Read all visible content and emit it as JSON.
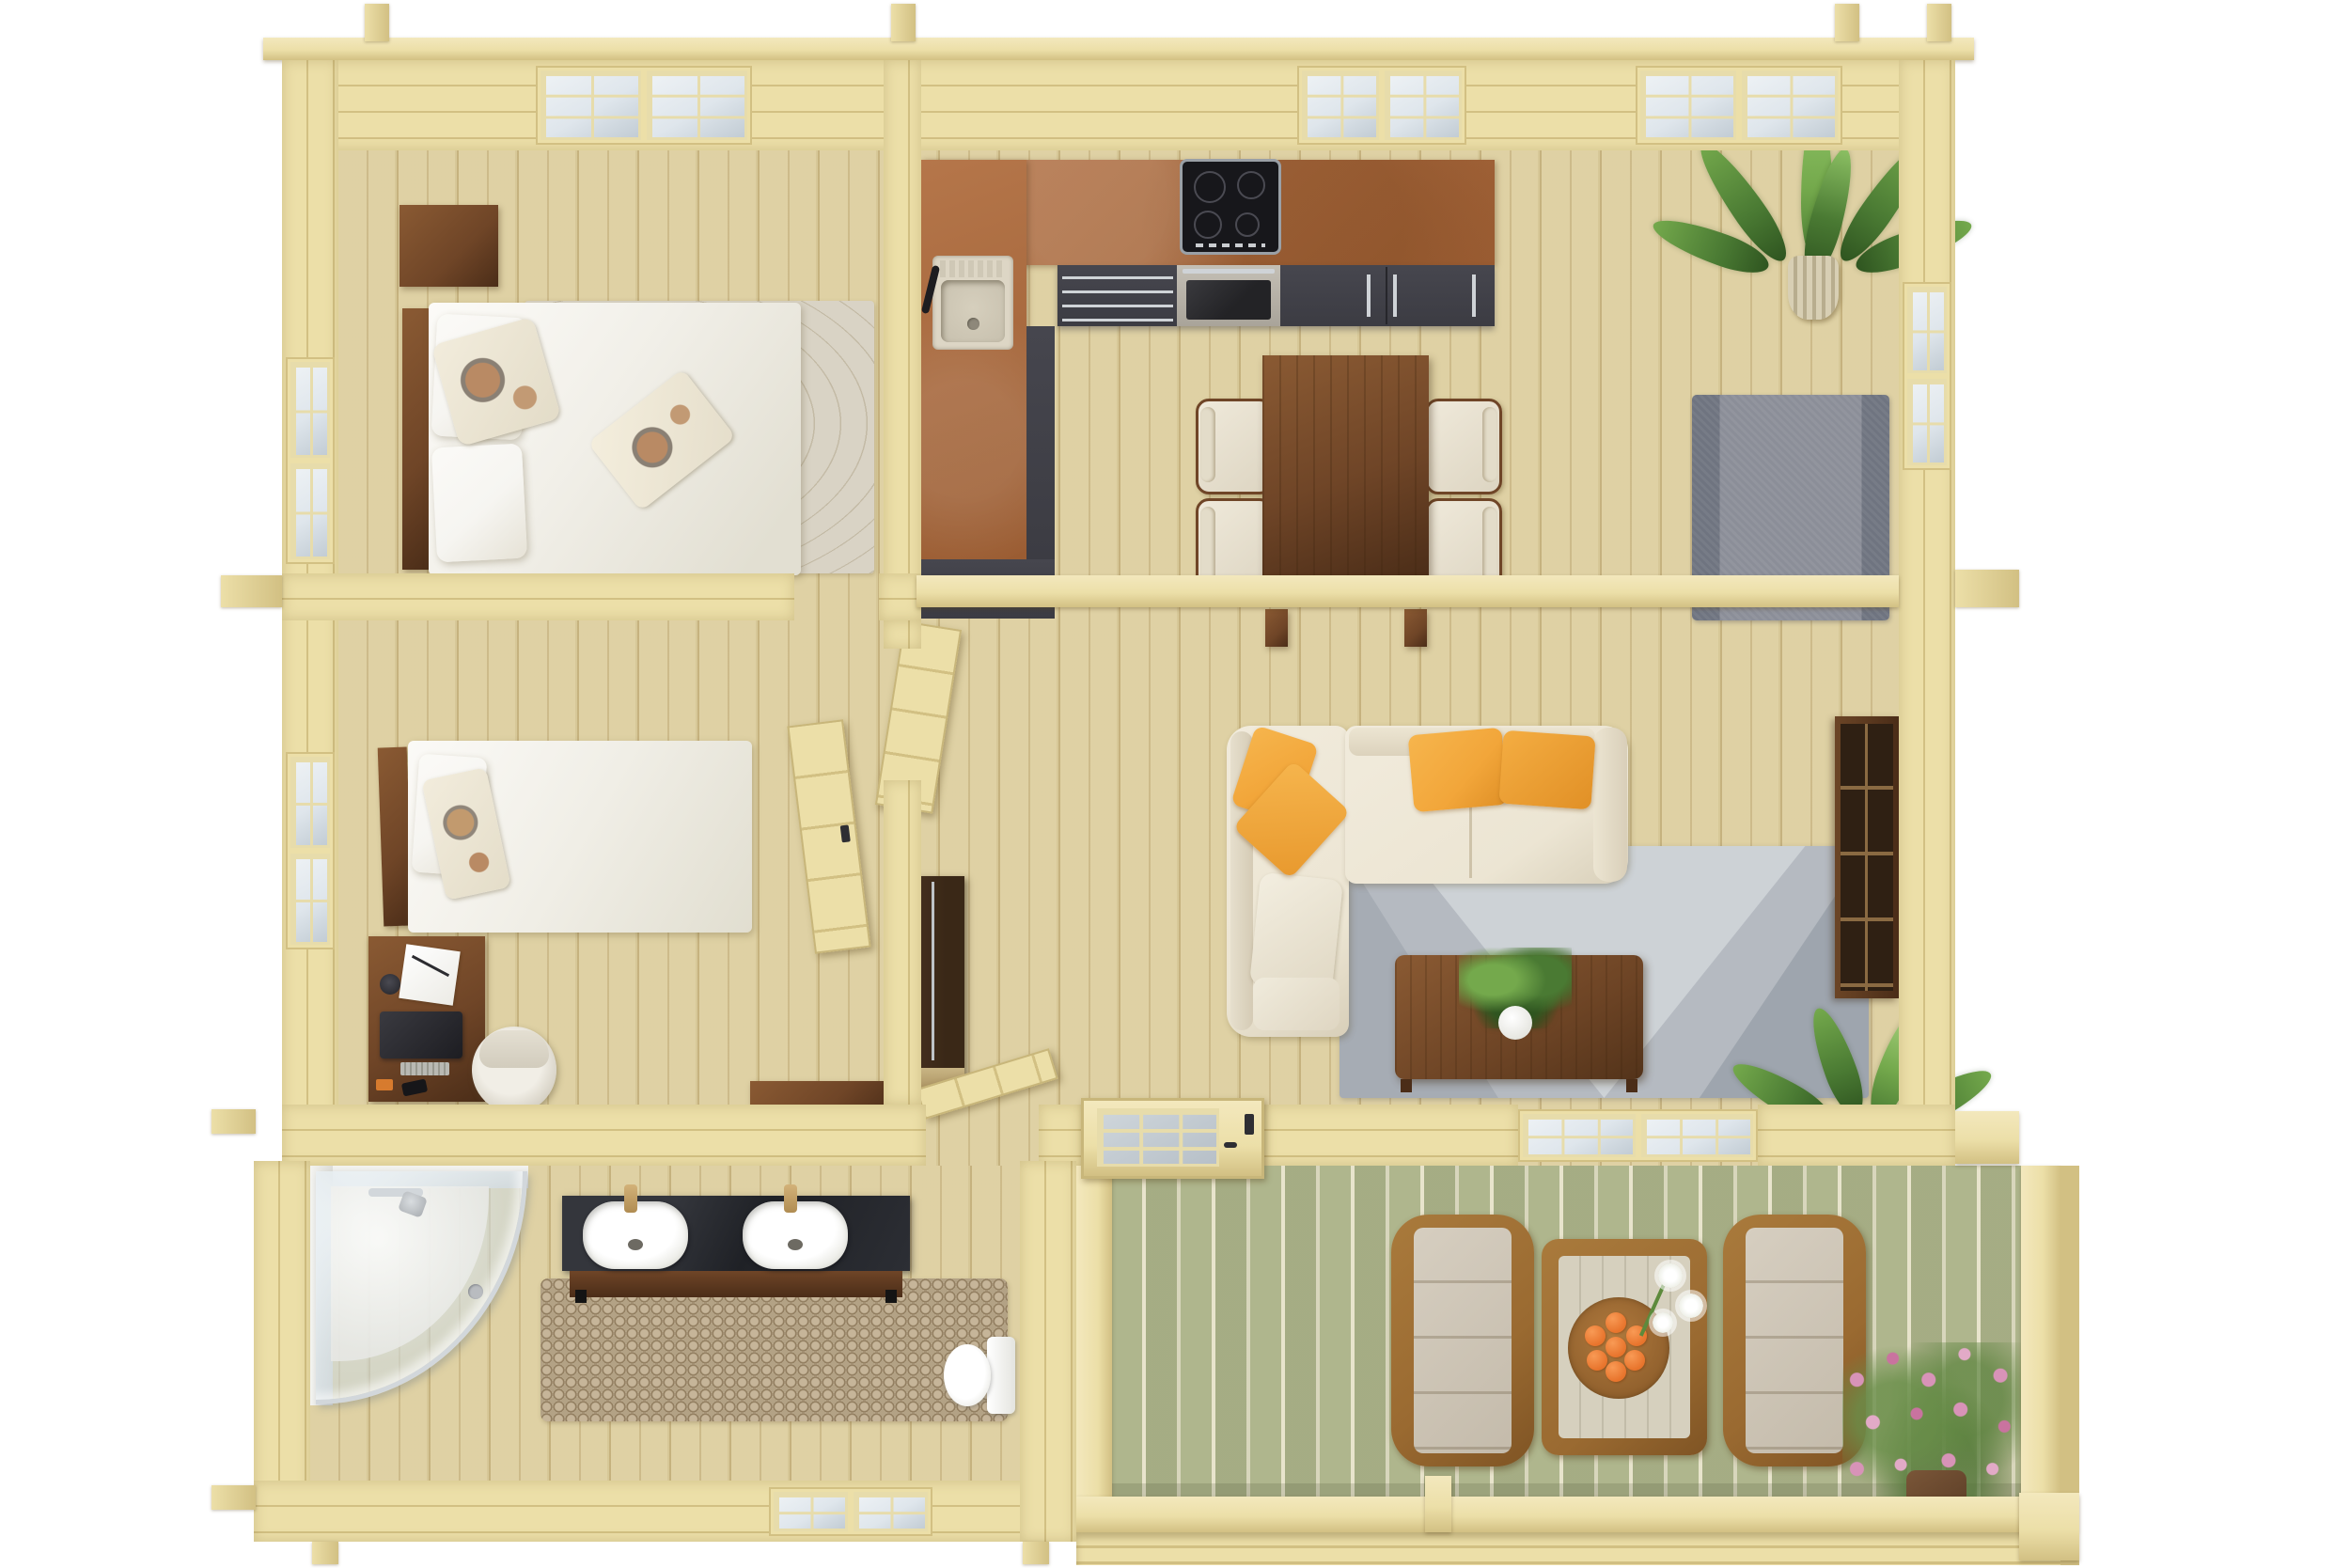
{
  "scene": {
    "title": "log-cabin floor plan 3D top view",
    "rooms": [
      {
        "name": "bedroom-double",
        "furniture": [
          "double-bed",
          "floral-pillows",
          "nightstand",
          "contour-rug"
        ],
        "windows": [
          "top-wall-window",
          "left-wall-window"
        ]
      },
      {
        "name": "kitchen",
        "furniture": [
          "l-shaped-counter",
          "sink",
          "induction-cooktop",
          "oven",
          "drawer-stack",
          "cabinet-doors"
        ],
        "counter_color_name": "cork-brown"
      },
      {
        "name": "dining-area",
        "furniture": [
          "walnut-table",
          "cream-chairs"
        ],
        "chair_count": 4
      },
      {
        "name": "living-room",
        "furniture": [
          "l-shaped-sofa",
          "orange-pillows",
          "geometric-gray-rug",
          "coffee-table",
          "fern-plant",
          "bookshelf",
          "floor-plant",
          "slate-rug",
          "palm-plant"
        ],
        "pillow_count": 4
      },
      {
        "name": "bedroom-single",
        "furniture": [
          "single-bed",
          "desk",
          "monitor",
          "notebook",
          "desk-chair",
          "bench"
        ],
        "windows": [
          "left-wall-window"
        ]
      },
      {
        "name": "hallway",
        "furniture": [
          "tall-cabinet",
          "parked-door-leaf"
        ]
      },
      {
        "name": "bathroom",
        "furniture": [
          "corner-shower",
          "double-sink-vanity",
          "toilet",
          "pebble-mat"
        ],
        "sink_count": 2,
        "windows": [
          "south-wall-window"
        ]
      },
      {
        "name": "terrace",
        "furniture": [
          "wicker-lounger-left",
          "wicker-lounger-right",
          "wicker-table",
          "orange-tray",
          "lily-vase",
          "pink-flower-bush",
          "railing"
        ],
        "orange_count": 7
      }
    ],
    "doors": [
      "bedroom-double-door",
      "bedroom-single-door",
      "bathroom-door",
      "front-door-glazed"
    ],
    "window_count": 8
  },
  "palette": {
    "wall": "#ecdfa8",
    "wallline": "#d2c083",
    "walledge": "#f3e8bd",
    "floor": "#ddcf9f",
    "floorline": "rgba(146,112,52,.25)",
    "deck": "#afb68d",
    "deckline": "#e8e4cc",
    "brown": "#b5764a",
    "browndark": "#9a5c32",
    "dark": "#3c3c43",
    "silver": "#cfd3d7",
    "walnut": "#6f4527",
    "walnutd": "#4b2d18",
    "walnutl": "#8a5a33",
    "espresso": "#3a2817",
    "cream": "#ece5d3",
    "creamd": "#d8cfb9",
    "orange": "#f2a63a",
    "ruggray": "#b5bac1",
    "ruggrayl": "#cdd2d6",
    "ruggrayd": "#99a0a9",
    "rugblue": "#8b8e98",
    "rugblued": "#6f7480",
    "rugbeige": "#d9d3c5",
    "pebble": "#c6b599",
    "white": "#f6f5f1",
    "glass": "#dfe6ec",
    "glassd": "#c2ccd4",
    "muntin": "#e7dcab",
    "chrome": "#d2d7db",
    "green": "#4a7a33",
    "greenl": "#74a94c",
    "greend": "#2f5520",
    "fruit": "#e8742c",
    "pink": "#d893b8",
    "wicker": "#9a6a31",
    "wickerd": "#7f5424",
    "sinkbeige": "#ddd6c5"
  }
}
